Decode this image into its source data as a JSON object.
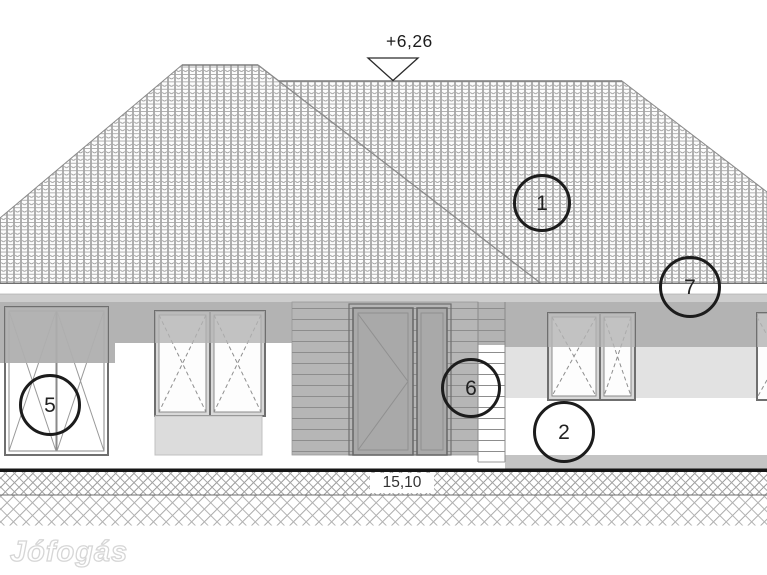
{
  "annotations": {
    "roof_level": "+6,26",
    "width_dimension": "15,10",
    "watermark": "Jófogás"
  },
  "markers": [
    {
      "label": "1",
      "x": 542,
      "y": 203,
      "r": 29
    },
    {
      "label": "7",
      "x": 690,
      "y": 287,
      "r": 31
    },
    {
      "label": "5",
      "x": 50,
      "y": 405,
      "r": 31
    },
    {
      "label": "6",
      "x": 471,
      "y": 388,
      "r": 30
    },
    {
      "label": "2",
      "x": 564,
      "y": 432,
      "r": 31
    }
  ],
  "colors": {
    "line": "#8a8a8a",
    "wall_shadow": "#b3b3b3",
    "cladding": "#b6b6b6",
    "door_leaf": "#a9a9a9",
    "light_band": "#e2e2e2",
    "sill_panel": "#dcdcdc",
    "plinth": "#c4c4c4",
    "ground_line": "#151515",
    "marker_stroke": "#1c1c1c",
    "watermark_outline": "#d6d6d6"
  }
}
